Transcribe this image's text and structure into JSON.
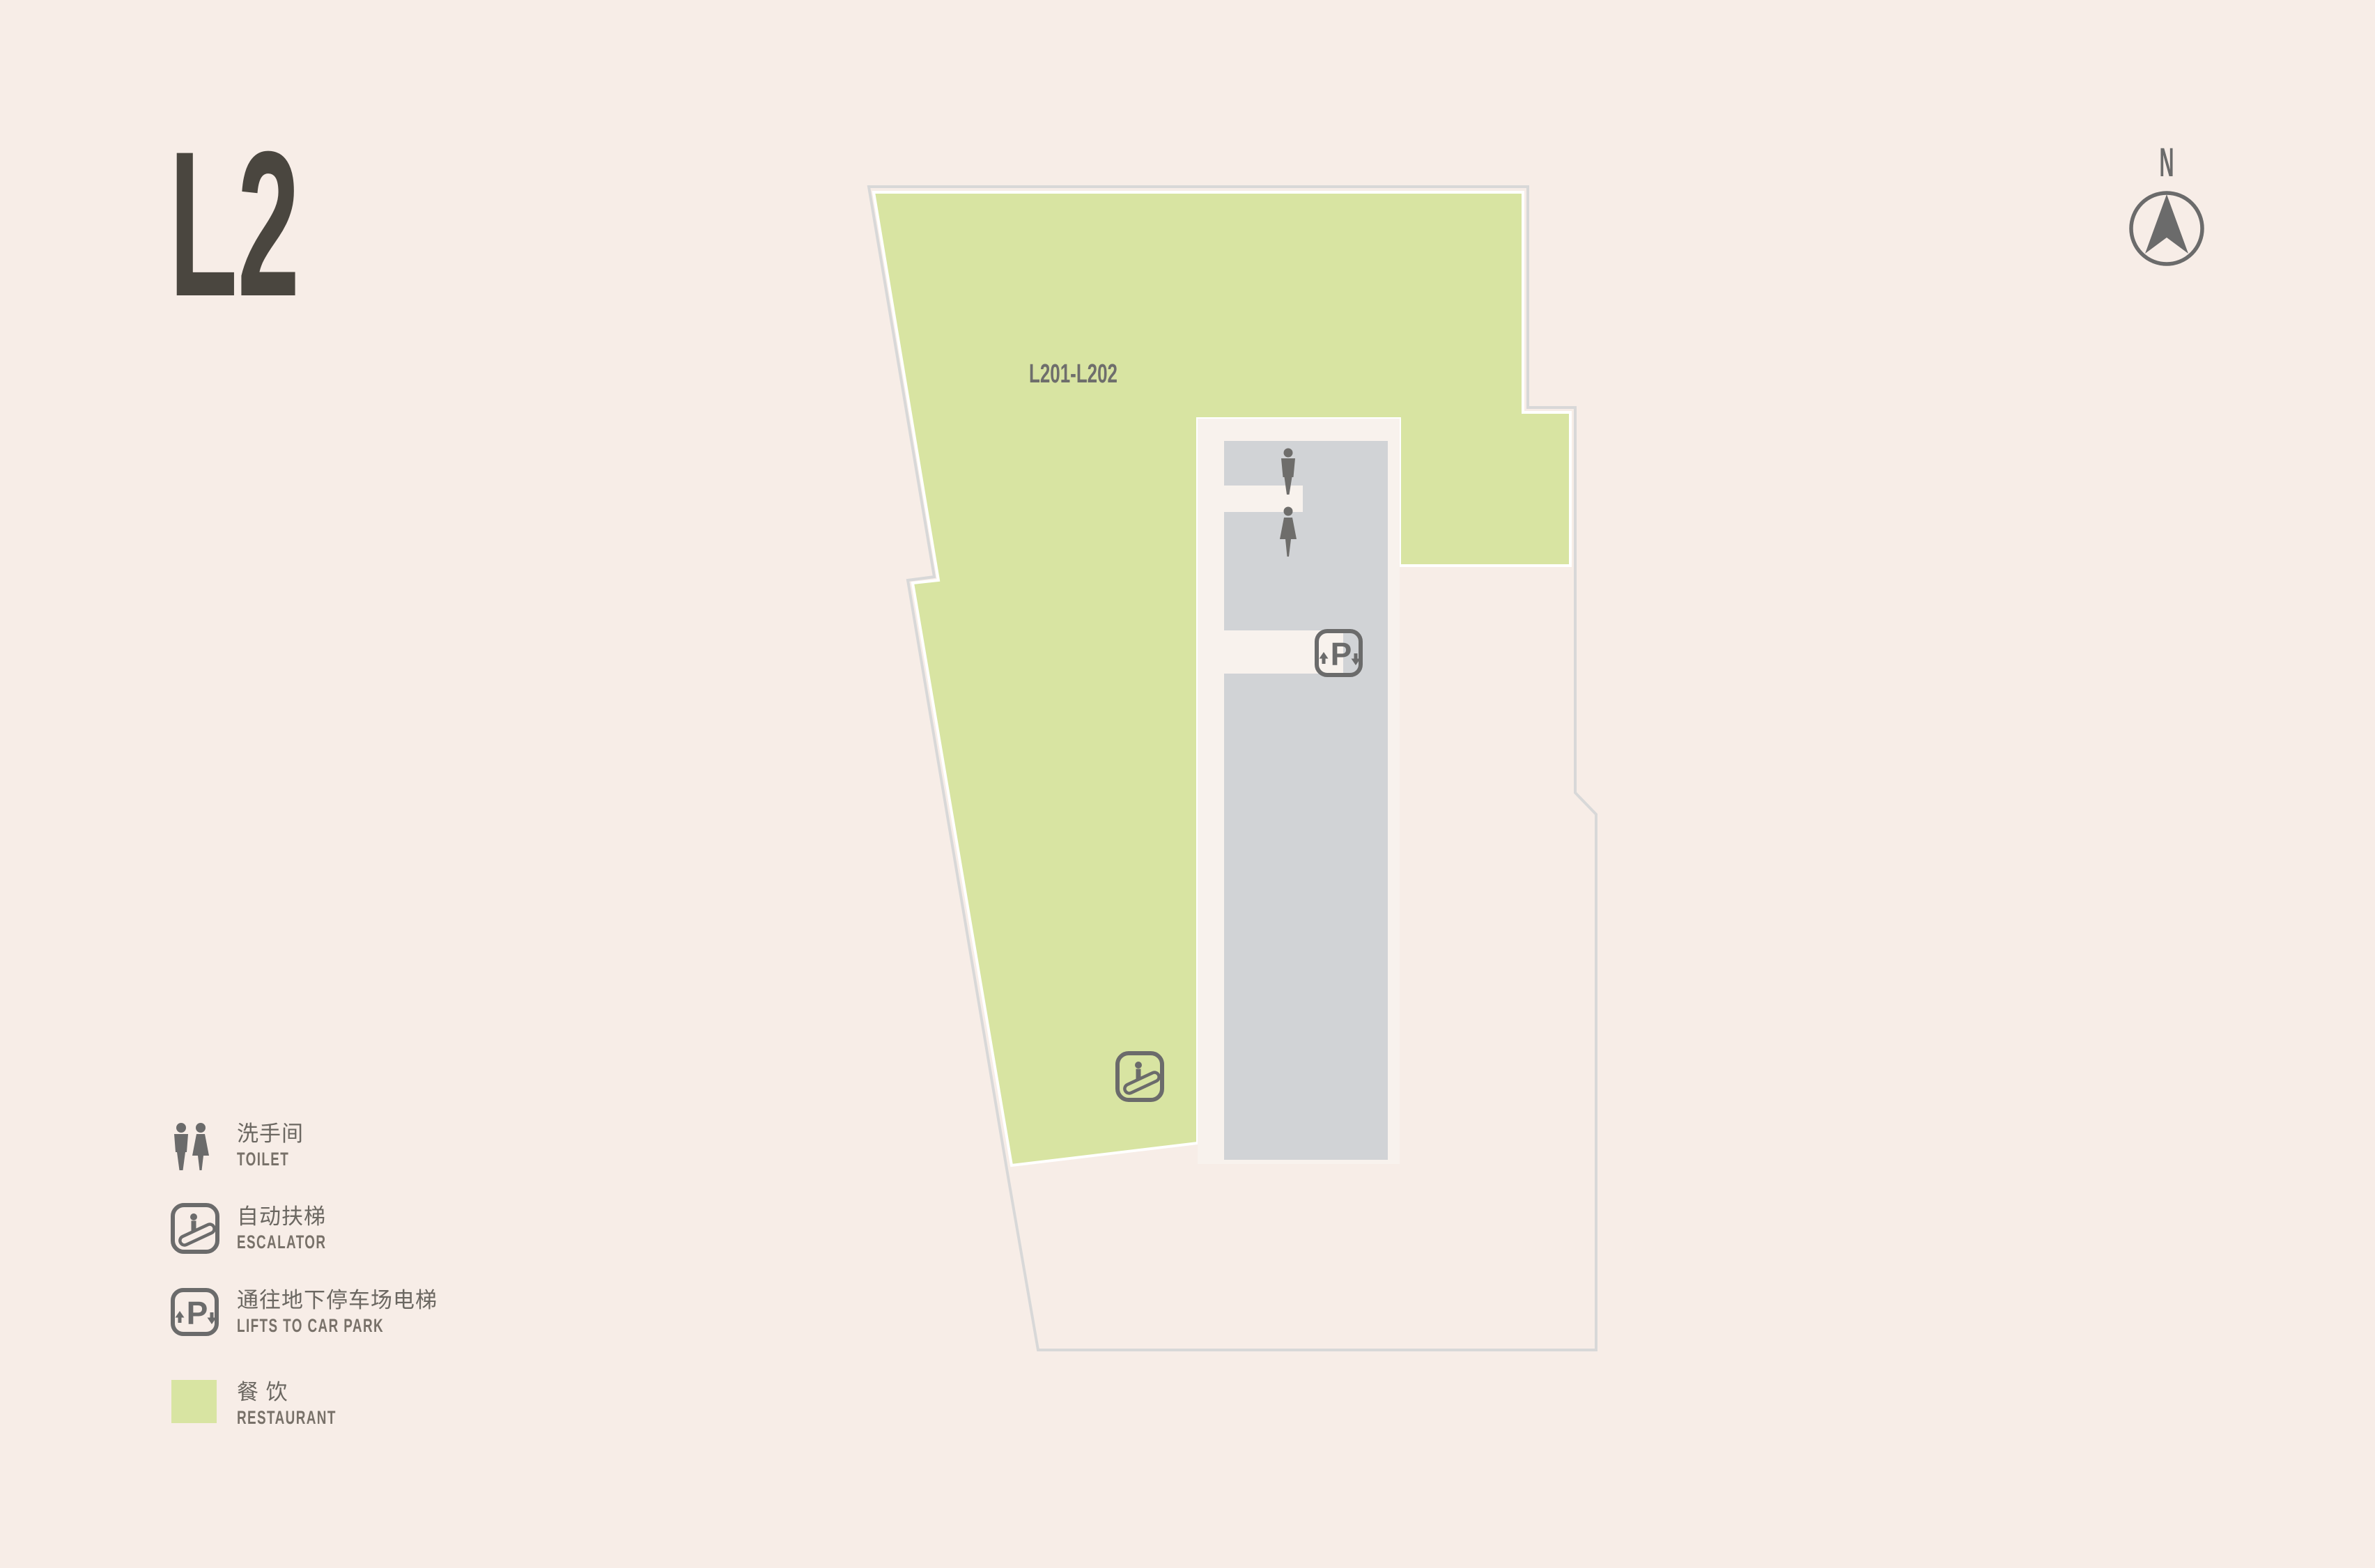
{
  "page": {
    "floor_label": "L2",
    "background": "#f7ede7",
    "title_color": "#4a463f"
  },
  "compass": {
    "label": "N",
    "color": "#6b6b6b"
  },
  "plan": {
    "unit_label": "L201-L202",
    "colors": {
      "restaurant": "#d8e4a2",
      "core": "#d1d3d6",
      "corridor": "#f8f2ed",
      "outline": "#d8d8d8",
      "icon": "#6b6b6b",
      "figure": "#6e6d6b",
      "unit_text": "#6e6e6c"
    }
  },
  "legend": {
    "items": [
      {
        "id": "toilet",
        "icon": "toilet-figures-icon",
        "zh": "洗手间",
        "en": "TOILET"
      },
      {
        "id": "escalator",
        "icon": "escalator-icon",
        "zh": "自动扶梯",
        "en": "ESCALATOR"
      },
      {
        "id": "car-park-lifts",
        "icon": "car-park-lift-icon",
        "zh": "通往地下停车场电梯",
        "en": "LIFTS TO CAR PARK"
      },
      {
        "id": "restaurant",
        "icon": "restaurant-swatch",
        "zh": "餐 饮",
        "en": "RESTAURANT"
      }
    ]
  }
}
